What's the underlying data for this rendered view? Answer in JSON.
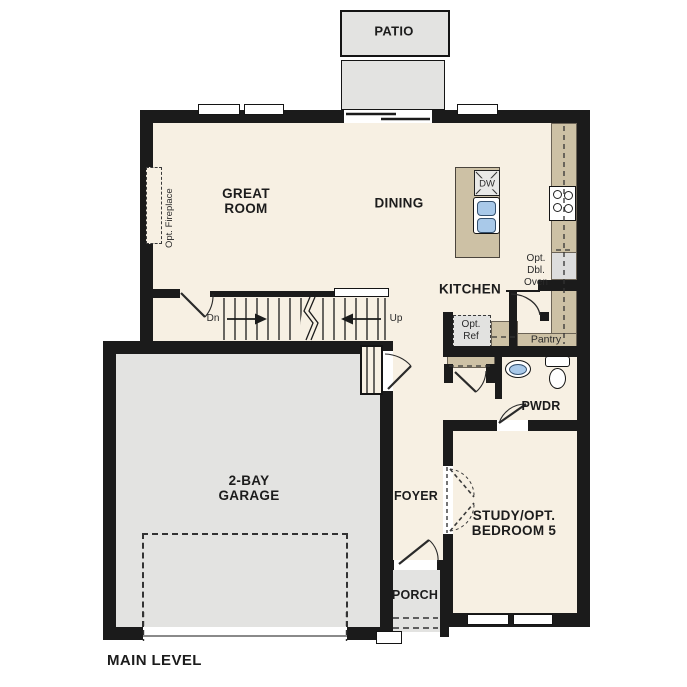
{
  "plan": {
    "title": "MAIN LEVEL",
    "rooms": {
      "patio": "PATIO",
      "great_room": {
        "line1": "GREAT",
        "line2": "ROOM"
      },
      "dining": "DINING",
      "kitchen": "KITCHEN",
      "garage": {
        "line1": "2-BAY",
        "line2": "GARAGE"
      },
      "foyer": "FOYER",
      "powder_room": "PWDR",
      "study": {
        "line1": "STUDY/OPT.",
        "line2": "BEDROOM 5"
      },
      "porch": "PORCH"
    },
    "annotations": {
      "opt_fireplace": "Opt. Fireplace",
      "dishwasher": "DW",
      "opt_double_oven": {
        "line1": "Opt.",
        "line2": "Dbl.",
        "line3": "Oven"
      },
      "opt_refrigerator": {
        "line1": "Opt.",
        "line2": "Ref"
      },
      "pantry": "Pantry",
      "stairs_down": "Dn",
      "stairs_up": "Up"
    },
    "colors": {
      "wall": "#1b1b1b",
      "floor": "#f7f0e3",
      "concrete": "#e3e3e1",
      "counter": "#cdc1a5",
      "appliance": "#dddddd",
      "sink_blue": "#a9c9e9",
      "ink": "#1c1c1c"
    }
  }
}
